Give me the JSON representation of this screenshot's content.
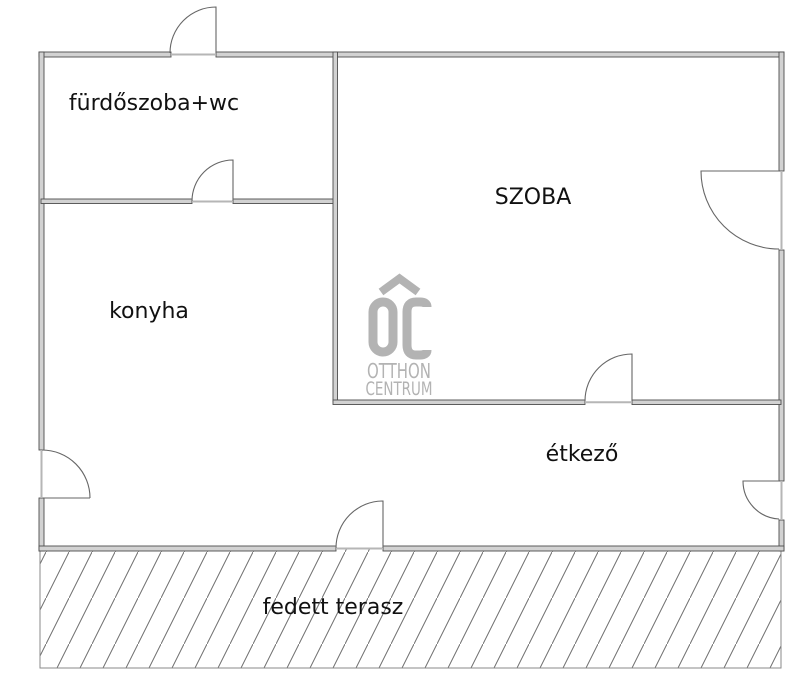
{
  "floorplan": {
    "labels": {
      "bathroom": "fürdőszoba+wc",
      "room": "SZOBA",
      "kitchen": "konyha",
      "dining": "étkező",
      "terrace": "fedett terasz"
    },
    "watermark": {
      "monogram": "OC",
      "line1": "OTTHON",
      "line2": "CENTRUM"
    },
    "colors": {
      "background": "#ffffff",
      "wall_fill": "#d2d2d2",
      "wall_edge": "#4d4d4d",
      "door_line": "#666666",
      "hatch_line": "#6e6e6e",
      "threshold": "#b6b6b6",
      "label_text": "#111111",
      "watermark_gray": "#b3b3b3"
    }
  }
}
